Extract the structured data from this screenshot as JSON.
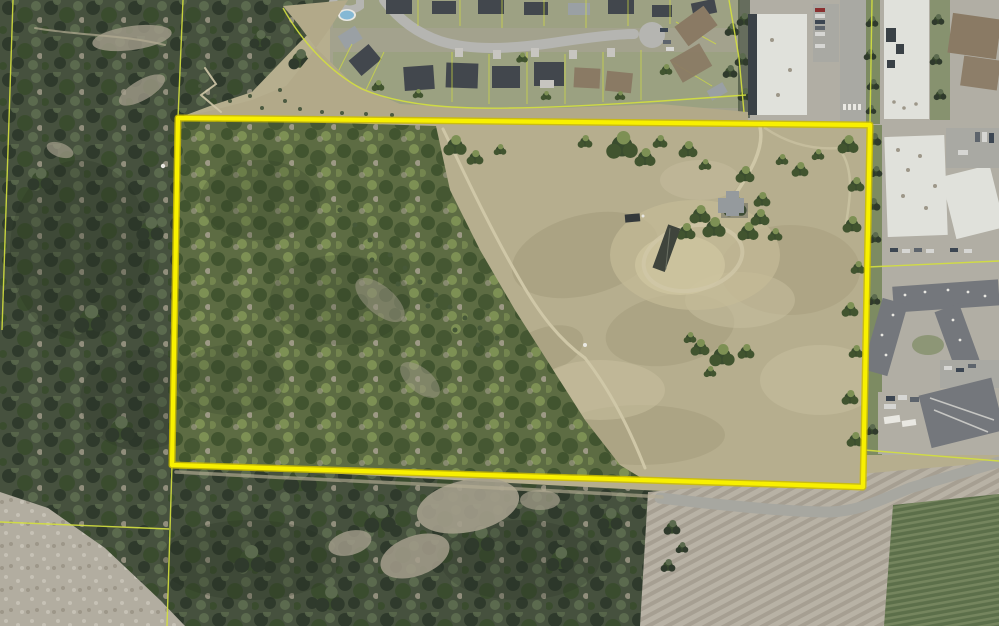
{
  "meta": {
    "type": "aerial-orthophoto-parcel-map",
    "image_width": 999,
    "image_height": 626,
    "description": "Aerial photo of a large rural parcel outlined with a thick yellow boundary; residential subdivision to the north, commercial and apartment buildings to the east, forested hillside to the west and south, vineyard and plowed field to the southeast. No text labels are visible."
  },
  "colors": {
    "boundary": "#f8f000",
    "boundary_edge": "#cdbd00",
    "parcel_line": "#d3de3f",
    "grass": "#b6ae8e",
    "grass_light": "#c8bf9f",
    "grass_olive": "#9a9372",
    "slope": "#b2a989",
    "forest_outside": "#46513e",
    "forest_outside_dark": "#2f3a2c",
    "forest_outside_light": "#5b6a4e",
    "forest_parcel": "#5d6c43",
    "forest_parcel_dark": "#41542f",
    "forest_parcel_light": "#7d9054",
    "tree_dark": "#3a4c2e",
    "street": "#b5b5b1",
    "road": "#a7a7a0",
    "driveway": "#c7c5c0",
    "lawn": "#93a076",
    "paving": "#b1aea4",
    "paving_dark": "#a9a9a3",
    "roof_dark": "#42474d",
    "roof_gray": "#9aa0a4",
    "roof_light": "#e0e1db",
    "roof_brown": "#8a7a64",
    "shadow": "#3a4146",
    "apartment_roof": "#74777c",
    "farm_roof": "#959a9d",
    "barn_roof": "#3f443c",
    "vehicle": "#34393b",
    "pool": "#85b8d4",
    "greenstrip": "#7d8b62",
    "clearing": "#a49e8c",
    "white_detail": "#e9e8e2",
    "trail": "#cfc7a7",
    "track": "#b3ac93",
    "vineyard_a": "#5c6f4a",
    "vineyard_b": "#75855e",
    "field_a": "#b8b2a5",
    "field_b": "#a69f92",
    "scree": "#b2ada0",
    "scree_speck": "#c6c1b5",
    "car_red": "#8a3030",
    "car_dark": "#3c4652",
    "car_white": "#d6d6d3",
    "car_gray": "#5d646c"
  },
  "parcel_boundary": {
    "points": "178,118 870,125 863,487 172,465",
    "stroke_width": 4.2,
    "edge_width": 7
  },
  "parcel_lines": {
    "segments": [
      {
        "name": "west-line-north-extension",
        "d": "M183,0 L178,118"
      },
      {
        "name": "east-line-north-extension",
        "d": "M872,0 L870,125"
      },
      {
        "name": "west-line-south-extension",
        "d": "M172,465 L167,626"
      },
      {
        "name": "southwest-branch-line",
        "d": "M0,522 L169,529"
      },
      {
        "name": "far-west-line",
        "d": "M13,0 L2,330"
      },
      {
        "name": "east-apartments-line",
        "d": "M868,267 L999,261"
      },
      {
        "name": "southeast-road-line",
        "d": "M864,450 L999,461"
      },
      {
        "name": "greenbelt-curve",
        "d": "M283,8 C302,42 330,72 362,89 C402,106 455,109 510,108 C575,107 635,103 690,99 L746,95"
      },
      {
        "name": "northeast-lot-line",
        "d": "M729,0 L739,58 L744,112"
      }
    ]
  }
}
